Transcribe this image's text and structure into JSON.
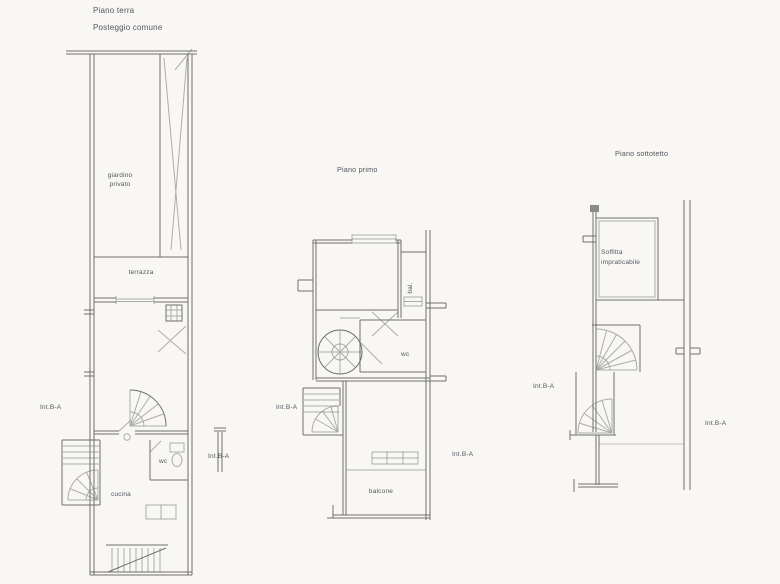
{
  "colors": {
    "bg": "#f8f7f4",
    "ink": "#6f6f70",
    "text": "#55555f"
  },
  "header": {
    "line1": "Piano terra",
    "line2": "Posteggio comune"
  },
  "ground_plan": {
    "garden_label_1": "giardino",
    "garden_label_2": "privato",
    "terrace_label": "terrazza",
    "unit_label_left": "Int.B-A",
    "wc_label": "wc",
    "kitchen_label": "cucina",
    "unit_label_right": "Int.B-A"
  },
  "first_plan": {
    "title": "Piano primo",
    "closet_label": "bal.",
    "wc_label": "wc",
    "unit_label_left": "Int.B-A",
    "unit_label_right": "Int.B-A",
    "balcony_label": "balcone"
  },
  "attic_plan": {
    "title": "Piano sottotetto",
    "attic_label_1": "Soffitta",
    "attic_label_2": "impraticabile",
    "unit_label_left": "Int.B-A",
    "unit_label_right": "Int.B-A"
  }
}
